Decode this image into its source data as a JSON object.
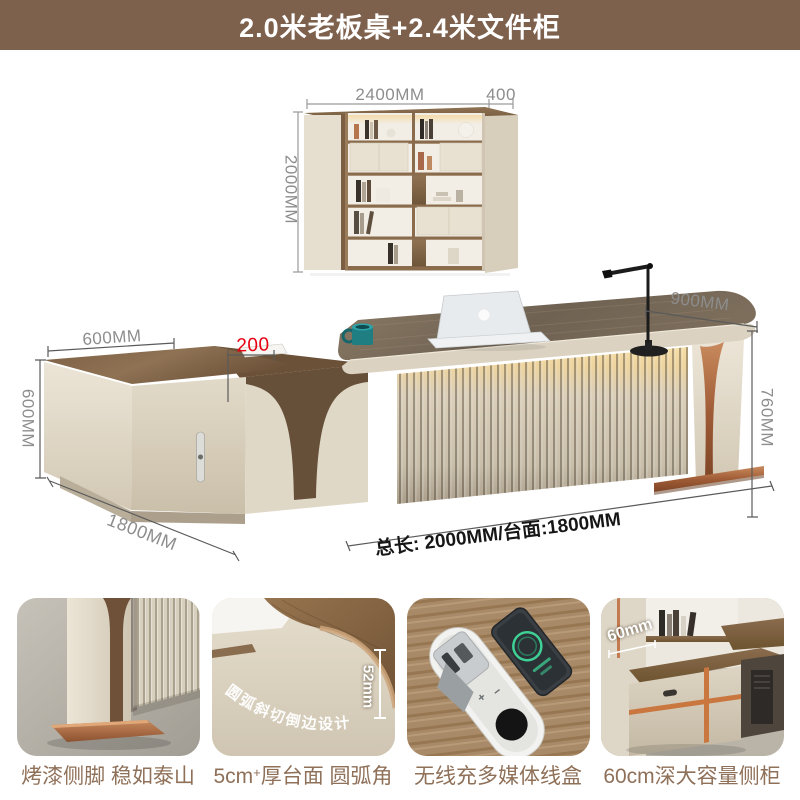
{
  "header": {
    "title": "2.0米老板桌+2.4米文件柜"
  },
  "bookshelf_figure": {
    "width_label": "2400MM",
    "depth_label": "400",
    "height_label": "2000MM"
  },
  "desk_figure": {
    "cabinet_width_label": "600MM",
    "cabinet_height_label": "600MM",
    "tier_offset_label": "200",
    "lamp_span_label": "900MM",
    "desk_height_label": "760MM",
    "cabinet_length_label": "1800MM",
    "total_label": "总长: 2000MM/台面:1800MM"
  },
  "features": [
    {
      "caption": "烤漆侧脚 稳如泰山"
    },
    {
      "caption_pre": "5cm",
      "caption_sup": "+",
      "caption_post": "厚台面 圆弧角",
      "thickness_note": "52mm",
      "arc_label": "圆弧斜切倒边设计"
    },
    {
      "caption": "无线充多媒体线盒"
    },
    {
      "caption": "60cm深大容量侧柜",
      "depth_note": "60mm"
    }
  ],
  "colors": {
    "header_bg": "#7d614d",
    "accent_red": "#e60012",
    "caption_text": "#8f7059",
    "dimension_text": "#8d8d8d",
    "wood": "#8a6e50",
    "cream": "#e7e0d2",
    "copper": "#b0714e",
    "led_glow": "#f5d9a0",
    "mug_teal": "#1f7e82"
  }
}
